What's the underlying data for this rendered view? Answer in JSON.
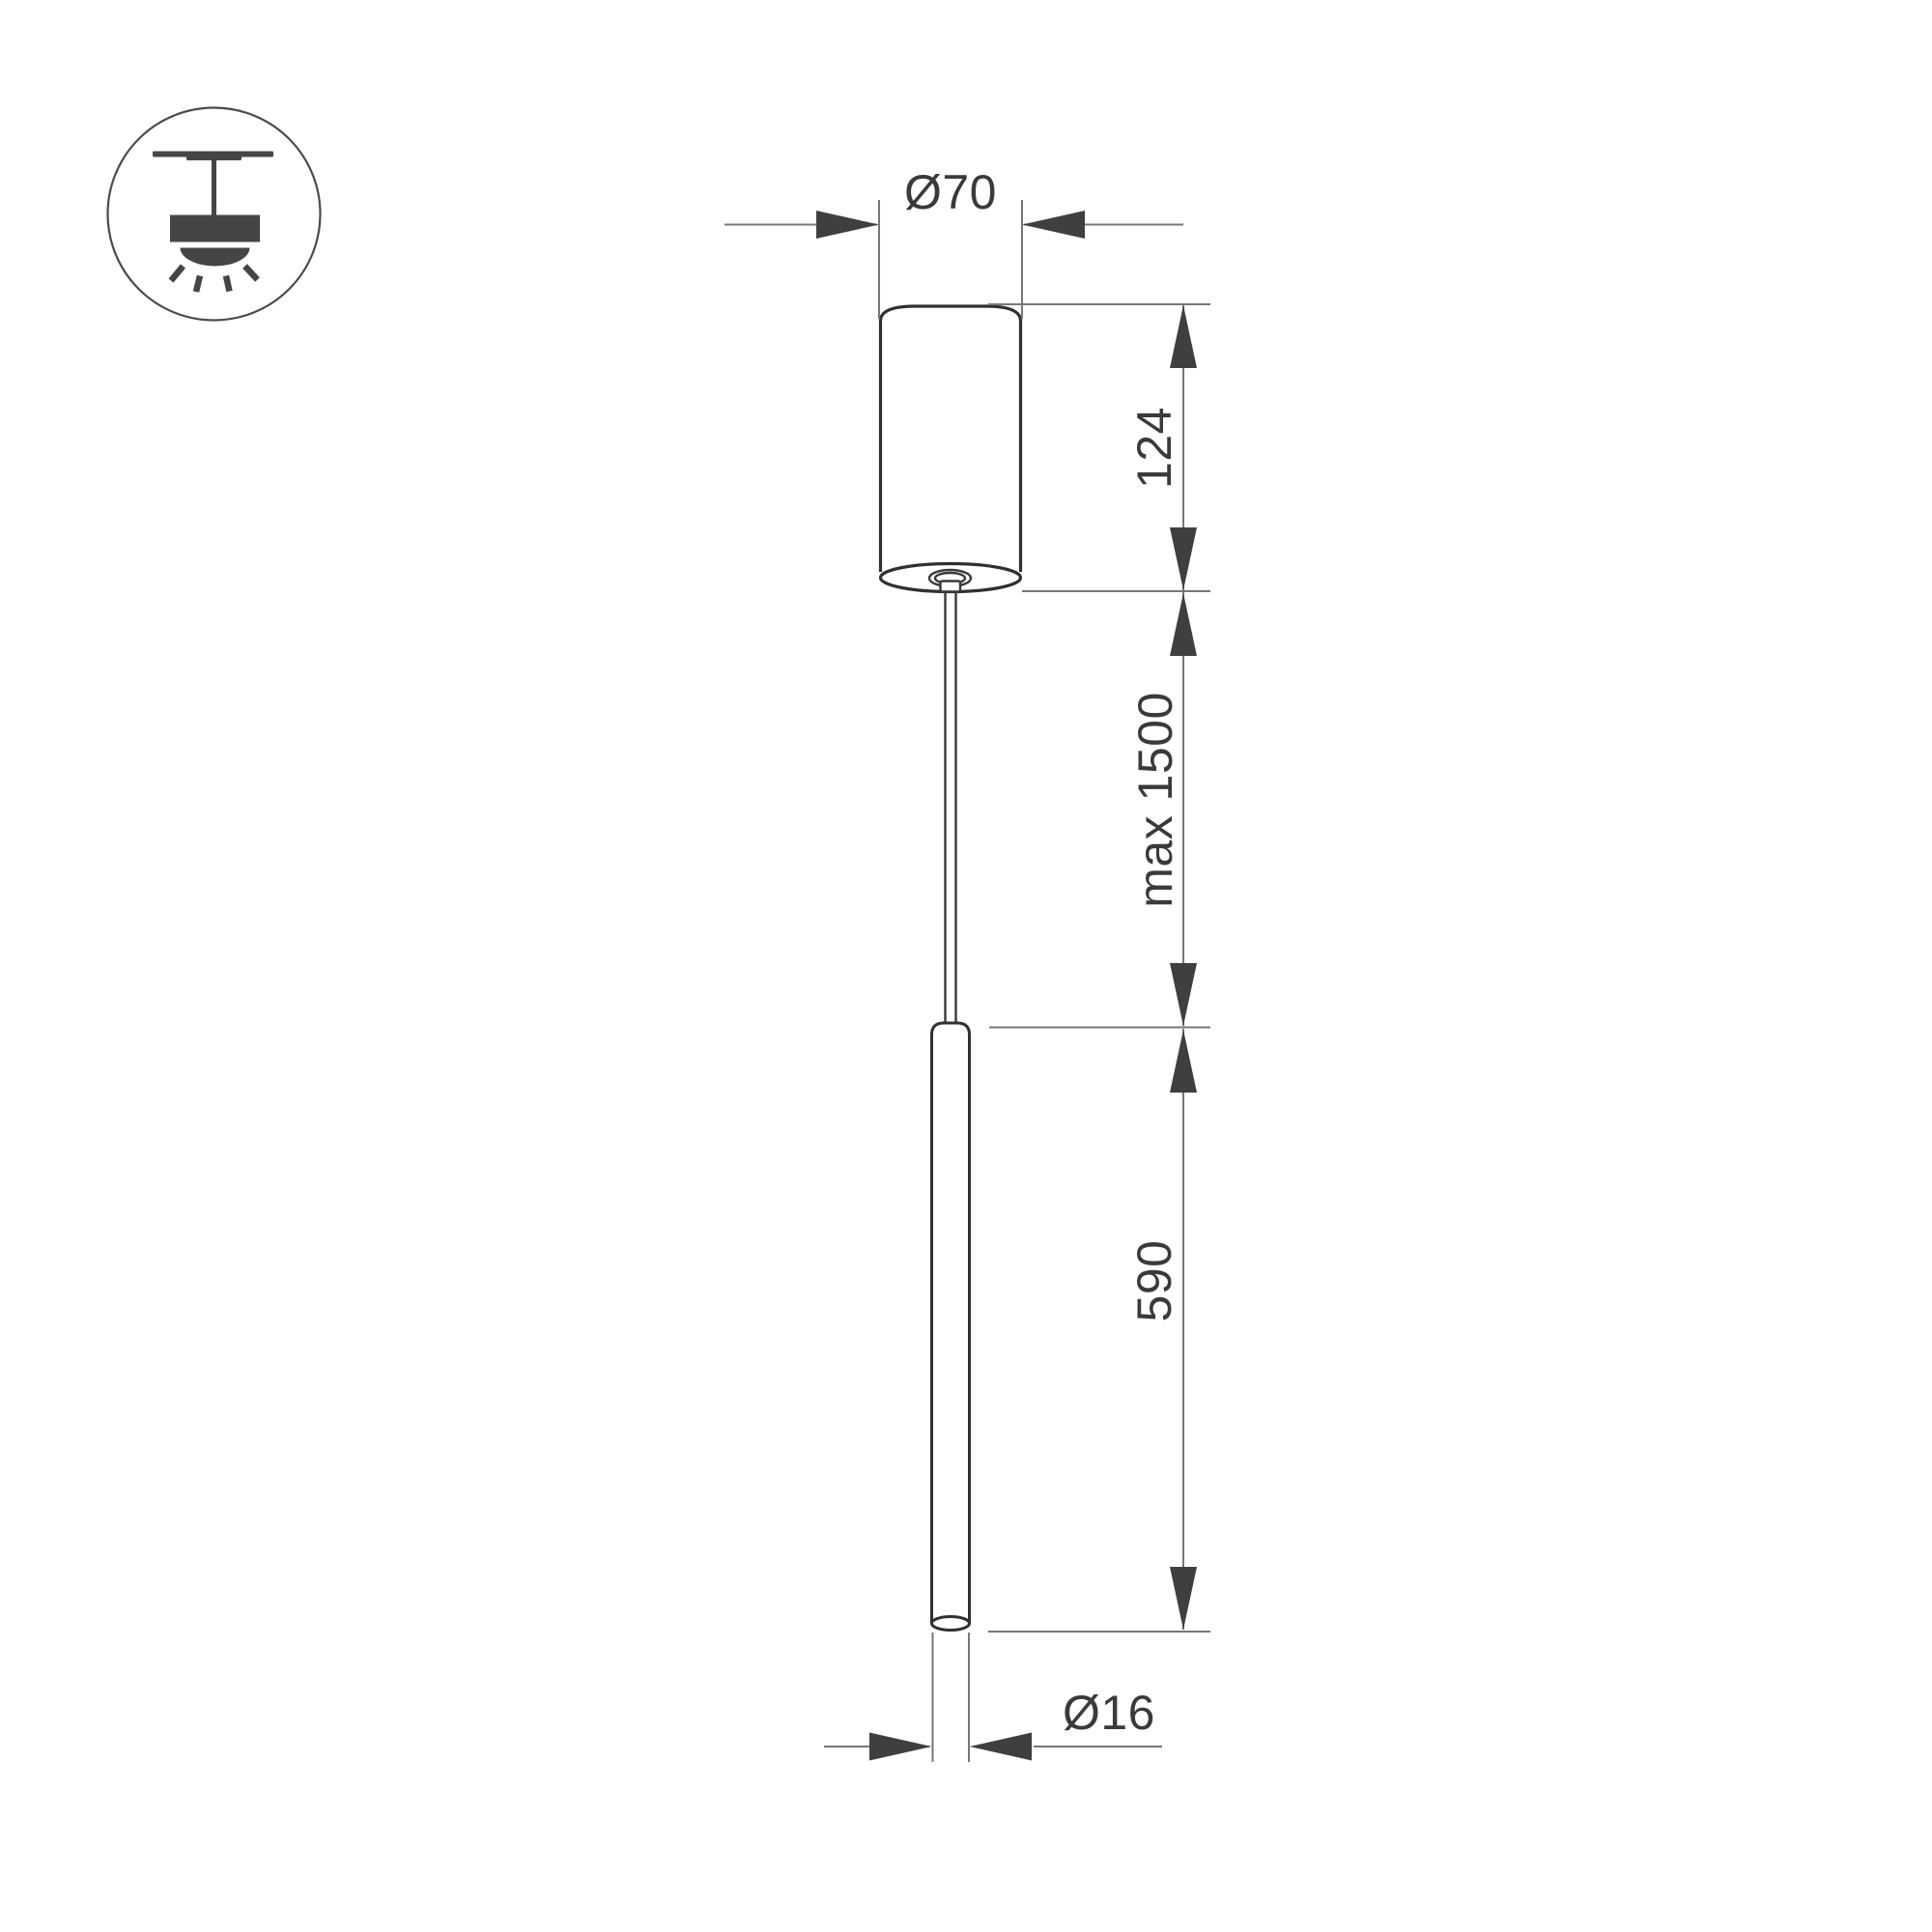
{
  "page": {
    "background": "#ffffff",
    "description_labels": {
      "canopy_diameter": "Ø70",
      "canopy_height": "124",
      "suspension_max": "max 1500",
      "tube_length": "590",
      "tube_diameter": "Ø16"
    }
  },
  "labels": {
    "canopy_diameter": "Ø70",
    "canopy_height": "124",
    "suspension_max": "max 1500",
    "tube_length": "590",
    "tube_diameter": "Ø16"
  },
  "dimensions_mm": {
    "canopy_diameter": 70,
    "canopy_height": 124,
    "suspension_max_length": 1500,
    "tube_length": 590,
    "tube_diameter": 16
  },
  "icons": {
    "mount_type": "pendant-ceiling-mount-icon"
  },
  "colors": {
    "background": "#ffffff",
    "object_outline": "#303032",
    "thin_line": "#77777a",
    "arrow": "#3f3f41",
    "text": "#3a3a3c",
    "icon": "#454547"
  }
}
